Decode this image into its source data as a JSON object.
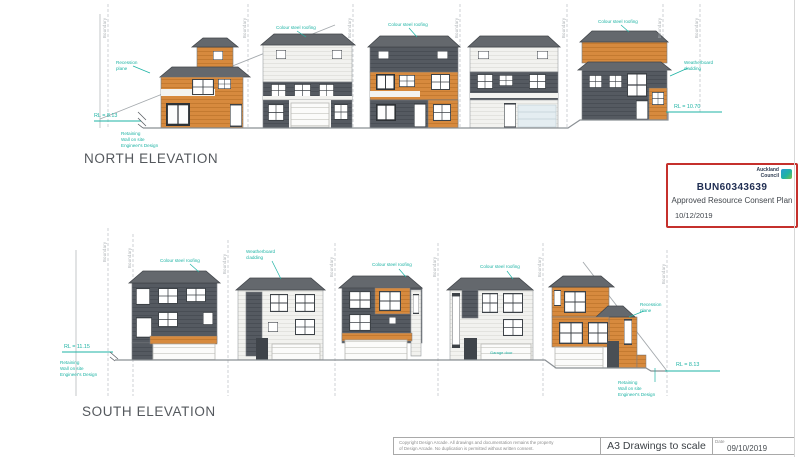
{
  "north": {
    "title": "NORTH ELEVATION",
    "rl_left": "RL = 8.13",
    "rl_right": "RL = 10.70"
  },
  "south": {
    "title": "SOUTH ELEVATION",
    "rl_left": "RL = 11.15",
    "rl_right": "RL = 8.13"
  },
  "notes": {
    "roof": "Colour steel roofing",
    "cladding": "Weatherboard cladding",
    "recession": "Recession plane",
    "retaining": "Retaining\nWall on site\nEngineer's Design",
    "garage": "Garage door",
    "boundary": "Boundary"
  },
  "stamp": {
    "org_line1": "Auckland",
    "org_line2": "Council",
    "number": "BUN60343639",
    "approval": "Approved Resource Consent Plan",
    "date": "10/12/2019"
  },
  "titleblock": {
    "copyright_line1": "Copyright Design Arcade. All drawings and documentation remains the property",
    "copyright_line2": "of Design Arcade. No duplication is permitted without written consent.",
    "scale_note": "A3 Drawings to scale",
    "date_label": "Date",
    "date_value": "09/10/2019"
  }
}
